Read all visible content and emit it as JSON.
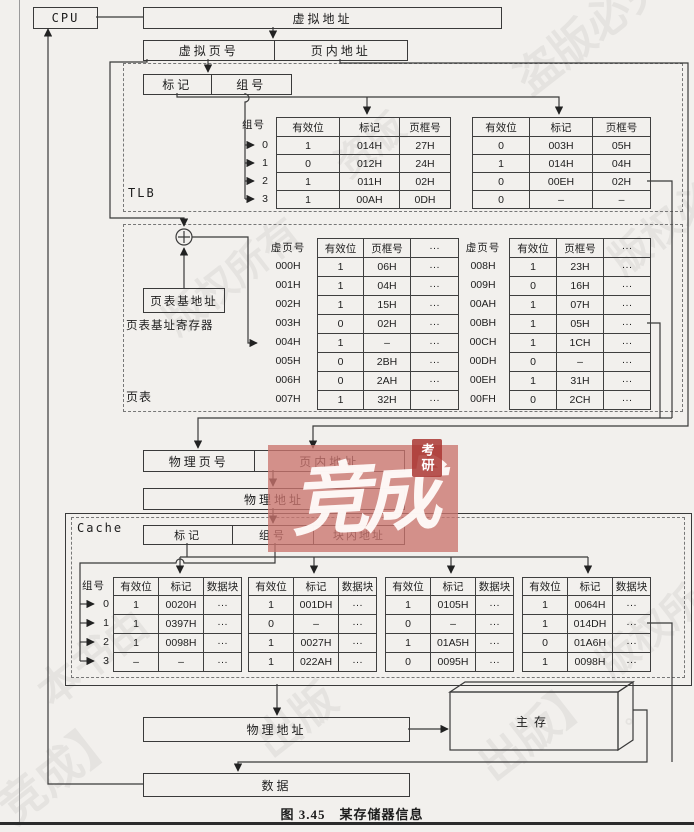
{
  "page": {
    "caption": "图 3.45　某存储器信息"
  },
  "top": {
    "cpu": "CPU",
    "virtual_address": "虚拟地址",
    "virtual_page_no": "虚拟页号",
    "page_offset": "页内地址"
  },
  "tlb": {
    "label": "TLB",
    "tag": "标记",
    "set": "组号",
    "set_col_header": "组号",
    "row_labels": [
      "0",
      "1",
      "2",
      "3"
    ],
    "left_table": {
      "headers": [
        "有效位",
        "标记",
        "页框号"
      ],
      "rows": [
        [
          "1",
          "014H",
          "27H"
        ],
        [
          "0",
          "012H",
          "24H"
        ],
        [
          "1",
          "011H",
          "02H"
        ],
        [
          "1",
          "00AH",
          "0DH"
        ]
      ]
    },
    "right_table": {
      "headers": [
        "有效位",
        "标记",
        "页框号"
      ],
      "rows": [
        [
          "0",
          "003H",
          "05H"
        ],
        [
          "1",
          "014H",
          "04H"
        ],
        [
          "0",
          "00EH",
          "02H"
        ],
        [
          "0",
          "–",
          "–"
        ]
      ]
    }
  },
  "page_table": {
    "label": "页表",
    "base_box": "页表基地址",
    "base_reg_label": "页表基址寄存器",
    "left": {
      "vpn_header": "虚页号",
      "vpn_labels": [
        "000H",
        "001H",
        "002H",
        "003H",
        "004H",
        "005H",
        "006H",
        "007H"
      ],
      "headers": [
        "有效位",
        "页框号",
        "···"
      ],
      "rows": [
        [
          "1",
          "06H",
          "···"
        ],
        [
          "1",
          "04H",
          "···"
        ],
        [
          "1",
          "15H",
          "···"
        ],
        [
          "0",
          "02H",
          "···"
        ],
        [
          "1",
          "–",
          "···"
        ],
        [
          "0",
          "2BH",
          "···"
        ],
        [
          "0",
          "2AH",
          "···"
        ],
        [
          "1",
          "32H",
          "···"
        ]
      ]
    },
    "right": {
      "vpn_header": "虚页号",
      "vpn_labels": [
        "008H",
        "009H",
        "00AH",
        "00BH",
        "00CH",
        "00DH",
        "00EH",
        "00FH"
      ],
      "headers": [
        "有效位",
        "页框号",
        "···"
      ],
      "rows": [
        [
          "1",
          "23H",
          "···"
        ],
        [
          "0",
          "16H",
          "···"
        ],
        [
          "1",
          "07H",
          "···"
        ],
        [
          "1",
          "05H",
          "···"
        ],
        [
          "1",
          "1CH",
          "···"
        ],
        [
          "0",
          "–",
          "···"
        ],
        [
          "1",
          "31H",
          "···"
        ],
        [
          "0",
          "2CH",
          "···"
        ]
      ]
    }
  },
  "physical": {
    "page_no": "物理页号",
    "offset": "页内地址",
    "address1": "物理地址",
    "address2": "物理地址"
  },
  "cache": {
    "label": "Cache",
    "tag": "标记",
    "set": "组号",
    "block_offset": "块内地址",
    "set_col_header": "组号",
    "row_labels": [
      "0",
      "1",
      "2",
      "3"
    ],
    "tables": [
      {
        "headers": [
          "有效位",
          "标记",
          "数据块"
        ],
        "rows": [
          [
            "1",
            "0020H",
            "···"
          ],
          [
            "1",
            "0397H",
            "···"
          ],
          [
            "1",
            "0098H",
            "···"
          ],
          [
            "–",
            "–",
            "···"
          ]
        ]
      },
      {
        "headers": [
          "有效位",
          "标记",
          "数据块"
        ],
        "rows": [
          [
            "1",
            "001DH",
            "···"
          ],
          [
            "0",
            "–",
            "···"
          ],
          [
            "1",
            "0027H",
            "···"
          ],
          [
            "1",
            "022AH",
            "···"
          ]
        ]
      },
      {
        "headers": [
          "有效位",
          "标记",
          "数据块"
        ],
        "rows": [
          [
            "1",
            "0105H",
            "···"
          ],
          [
            "0",
            "–",
            "···"
          ],
          [
            "1",
            "01A5H",
            "···"
          ],
          [
            "0",
            "0095H",
            "···"
          ]
        ]
      },
      {
        "headers": [
          "有效位",
          "标记",
          "数据块"
        ],
        "rows": [
          [
            "1",
            "0064H",
            "···"
          ],
          [
            "1",
            "014DH",
            "···"
          ],
          [
            "0",
            "01A6H",
            "···"
          ],
          [
            "1",
            "0098H",
            "···"
          ]
        ]
      }
    ]
  },
  "memory": {
    "main": "主存",
    "data": "数据"
  },
  "watermarks": {
    "red_text": "竞成",
    "seal": "考研",
    "items": [
      {
        "text": "盗版必究",
        "x": 500,
        "y": -5,
        "r": -38,
        "s": 44
      },
      {
        "text": "版权必究",
        "x": 596,
        "y": 185,
        "r": -38,
        "s": 40
      },
      {
        "text": "版权所有",
        "x": 150,
        "y": 245,
        "r": -38,
        "s": 40
      },
      {
        "text": "资版",
        "x": 330,
        "y": 115,
        "r": -38,
        "s": 38
      },
      {
        "text": "本书由",
        "x": 28,
        "y": 625,
        "r": -38,
        "s": 42
      },
      {
        "text": "竞成】",
        "x": -12,
        "y": 735,
        "r": -38,
        "s": 46
      },
      {
        "text": "出版",
        "x": 250,
        "y": 685,
        "r": -38,
        "s": 44
      },
      {
        "text": "出版】",
        "x": 468,
        "y": 695,
        "r": -38,
        "s": 44
      },
      {
        "text": "版权所",
        "x": 588,
        "y": 600,
        "r": -38,
        "s": 40
      },
      {
        "text": "。",
        "x": 625,
        "y": 700,
        "r": 0,
        "s": 20
      }
    ]
  }
}
